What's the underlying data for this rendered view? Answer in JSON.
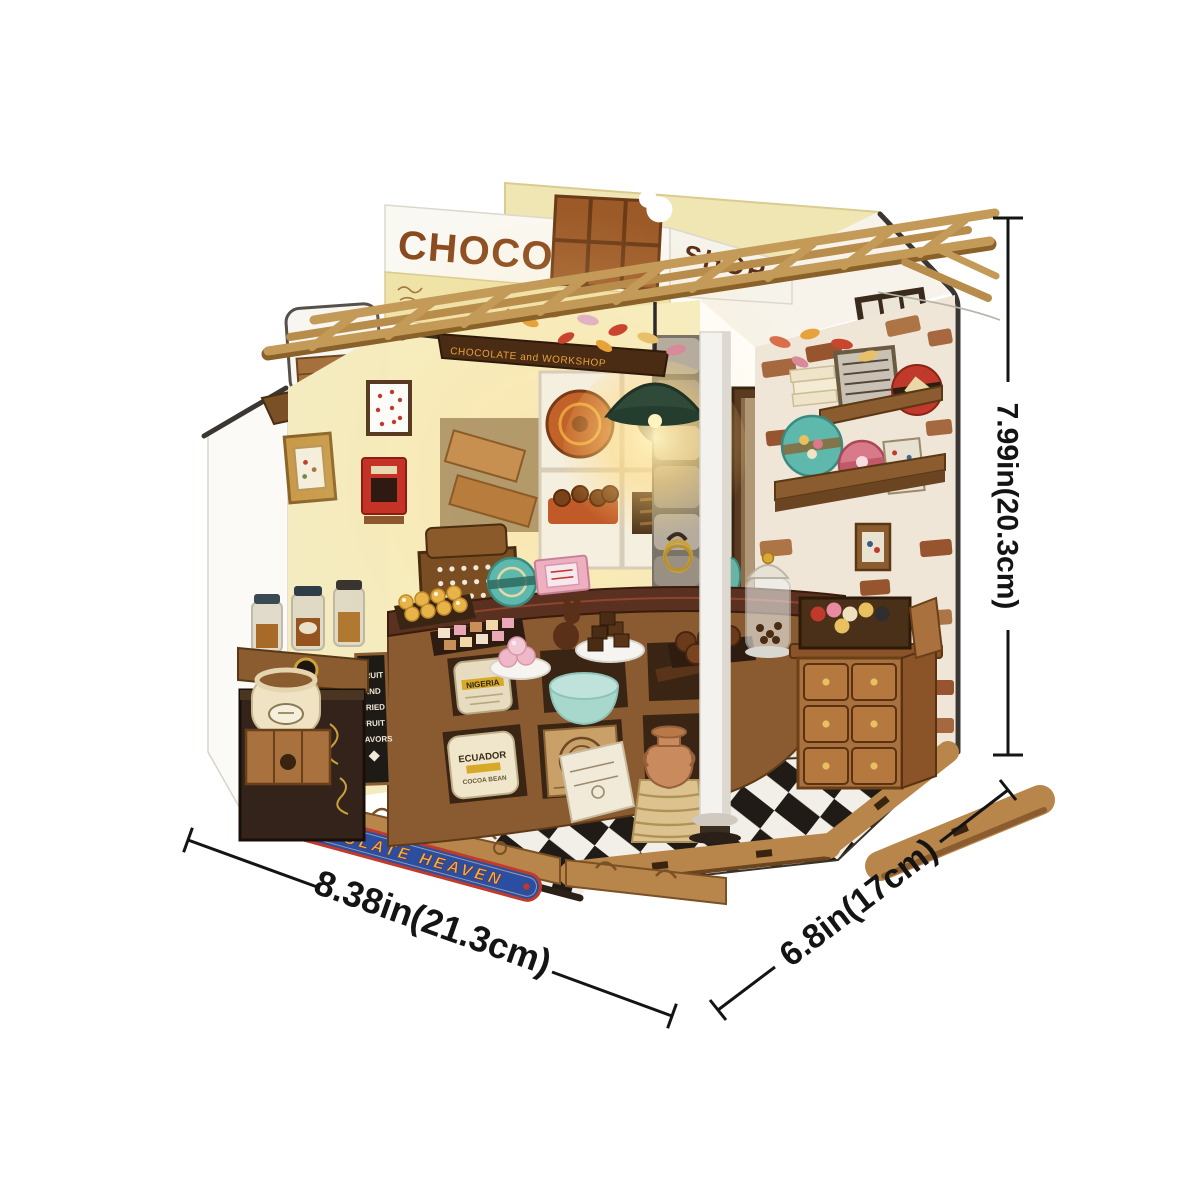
{
  "meta": {
    "description": "Product photo of a DIY miniature dollhouse kit: a corner chocolate-shop diorama with warm interior lighting, shown on a white background with measurement annotations.",
    "background": "#ffffff"
  },
  "model": {
    "signs": {
      "roof_main": "CHOCOLATE",
      "roof_side": "SHOP",
      "fascia_year": "1693",
      "hanging_sign": "CHOCOLATE and WORKSHOP",
      "base_banner": "CHOCOLATE HEAVEN"
    },
    "chalkboard": {
      "words": [
        "FRUIT",
        "AND",
        "DRIED",
        "FRUIT",
        "FLAVORS"
      ]
    },
    "sacks": {
      "nigeria": "NIGERIA",
      "ecuador_line1": "ECUADOR",
      "ecuador_line2": "COCOA BEAN"
    },
    "colors": {
      "wood": "#b8854a",
      "dark_wood": "#5a3a1c",
      "wall_yellow": "#f4ecc0",
      "banner_blue": "#2b4ea0",
      "banner_gold": "#e8b64a",
      "banner_red": "#c23b2a",
      "brick": "#a5683f",
      "lamp_green": "#2f4a38",
      "floor_black": "#201b16",
      "floor_white": "#f2efe8",
      "chocolate": "#8a4a1f"
    }
  },
  "dimensions": {
    "height_label": "7.99in(20.3cm)",
    "width_label": "8.38in(21.3cm)",
    "depth_label": "6.8in(17cm)"
  }
}
